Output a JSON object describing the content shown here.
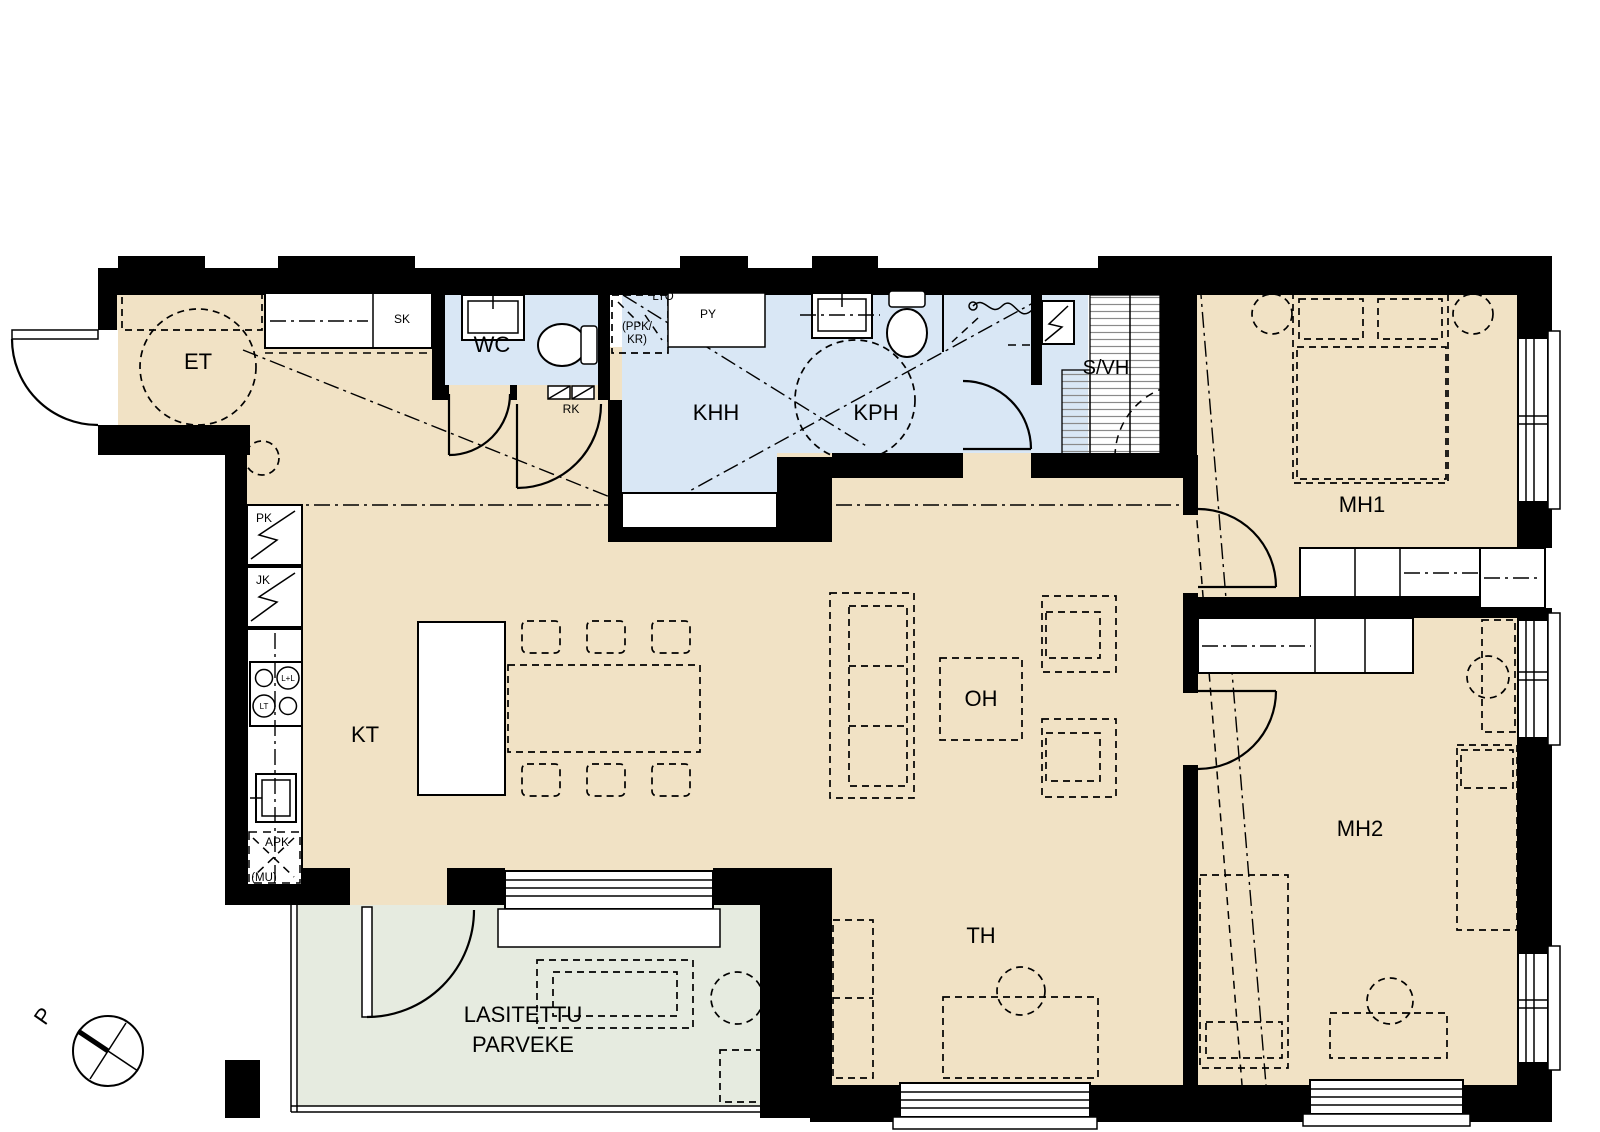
{
  "title": "apartment-floor-plan",
  "labels": {
    "et": "ET",
    "sk": "SK",
    "wc": "WC",
    "rk": "RK",
    "khh": "KHH",
    "kph": "KPH",
    "svh": "S/VH",
    "lto": "LTO",
    "ppk": "(PPK/",
    "kr": "KR)",
    "py": "PY",
    "pk": "PK",
    "jk": "JK",
    "ll": "L+L",
    "lt": "LT",
    "apk": "APK",
    "mu": "(MU)",
    "kt": "KT",
    "oh": "OH",
    "th": "TH",
    "mh1": "MH1",
    "mh2": "MH2",
    "balcony1": "LASITETTU",
    "balcony2": "PARVEKE",
    "north": "P"
  },
  "colors": {
    "wall": "#000000",
    "floor": "#f1e2c5",
    "wet_room": "#d9e7f5",
    "balcony": "#e6ebe0",
    "bench_stripe": "#8a8a8a",
    "line": "#000000"
  }
}
